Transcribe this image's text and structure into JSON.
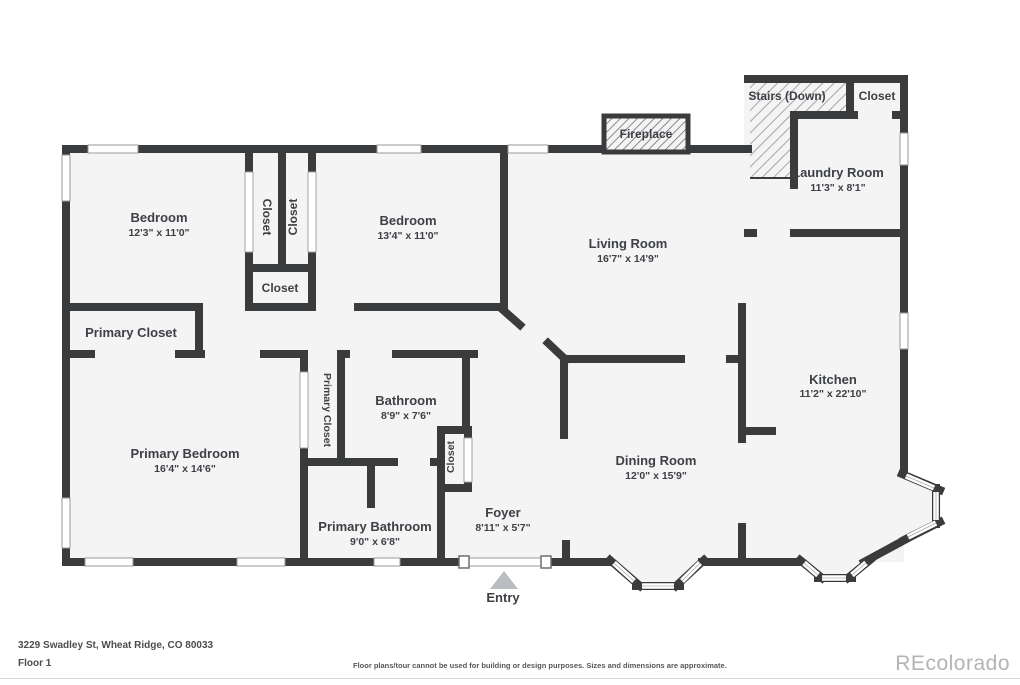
{
  "colors": {
    "wall": "#3a3b3d",
    "room_fill": "#f4f4f5",
    "background": "#ffffff",
    "hatch_line_stairs": "#9b9c9e",
    "hatch_line_fireplace": "#6a6b6e",
    "text": "#3d4045",
    "entry_arrow": "#b9bcc0",
    "watermark": "#b3b4b6"
  },
  "rooms": {
    "bedroom_left": {
      "name": "Bedroom",
      "dims": "12'3\" x 11'0\""
    },
    "bedroom_middle": {
      "name": "Bedroom",
      "dims": "13'4\" x 11'0\""
    },
    "living_room": {
      "name": "Living Room",
      "dims": "16'7\" x 14'9\""
    },
    "kitchen": {
      "name": "Kitchen",
      "dims": "11'2\" x 22'10\""
    },
    "dining_room": {
      "name": "Dining Room",
      "dims": "12'0\" x 15'9\""
    },
    "laundry_room": {
      "name": "Laundry Room",
      "dims": "11'3\" x 8'1\""
    },
    "stairs": {
      "name": "Stairs (Down)"
    },
    "closet_top_right": {
      "name": "Closet"
    },
    "fireplace": {
      "name": "Fireplace"
    },
    "closet_bedroom_left": {
      "name": "Closet"
    },
    "closet_bedroom_middle": {
      "name": "Closet"
    },
    "closet_hall": {
      "name": "Closet"
    },
    "primary_closet_room": {
      "name": "Primary Closet"
    },
    "primary_closet_tall": {
      "name": "Primary Closet"
    },
    "bathroom": {
      "name": "Bathroom",
      "dims": "8'9\" x 7'6\""
    },
    "closet_bathroom": {
      "name": "Closet"
    },
    "primary_bedroom": {
      "name": "Primary Bedroom",
      "dims": "16'4\" x 14'6\""
    },
    "primary_bathroom": {
      "name": "Primary Bathroom",
      "dims": "9'0\" x 6'8\""
    },
    "foyer": {
      "name": "Foyer",
      "dims": "8'11\" x 5'7\""
    },
    "entry": {
      "name": "Entry"
    }
  },
  "footer": {
    "address": "3229 Swadley St, Wheat Ridge, CO 80033",
    "floor": "Floor 1",
    "disclaimer": "Floor plans/tour cannot be used for building or design purposes. Sizes and dimensions are approximate.",
    "watermark": "REcolorado"
  }
}
